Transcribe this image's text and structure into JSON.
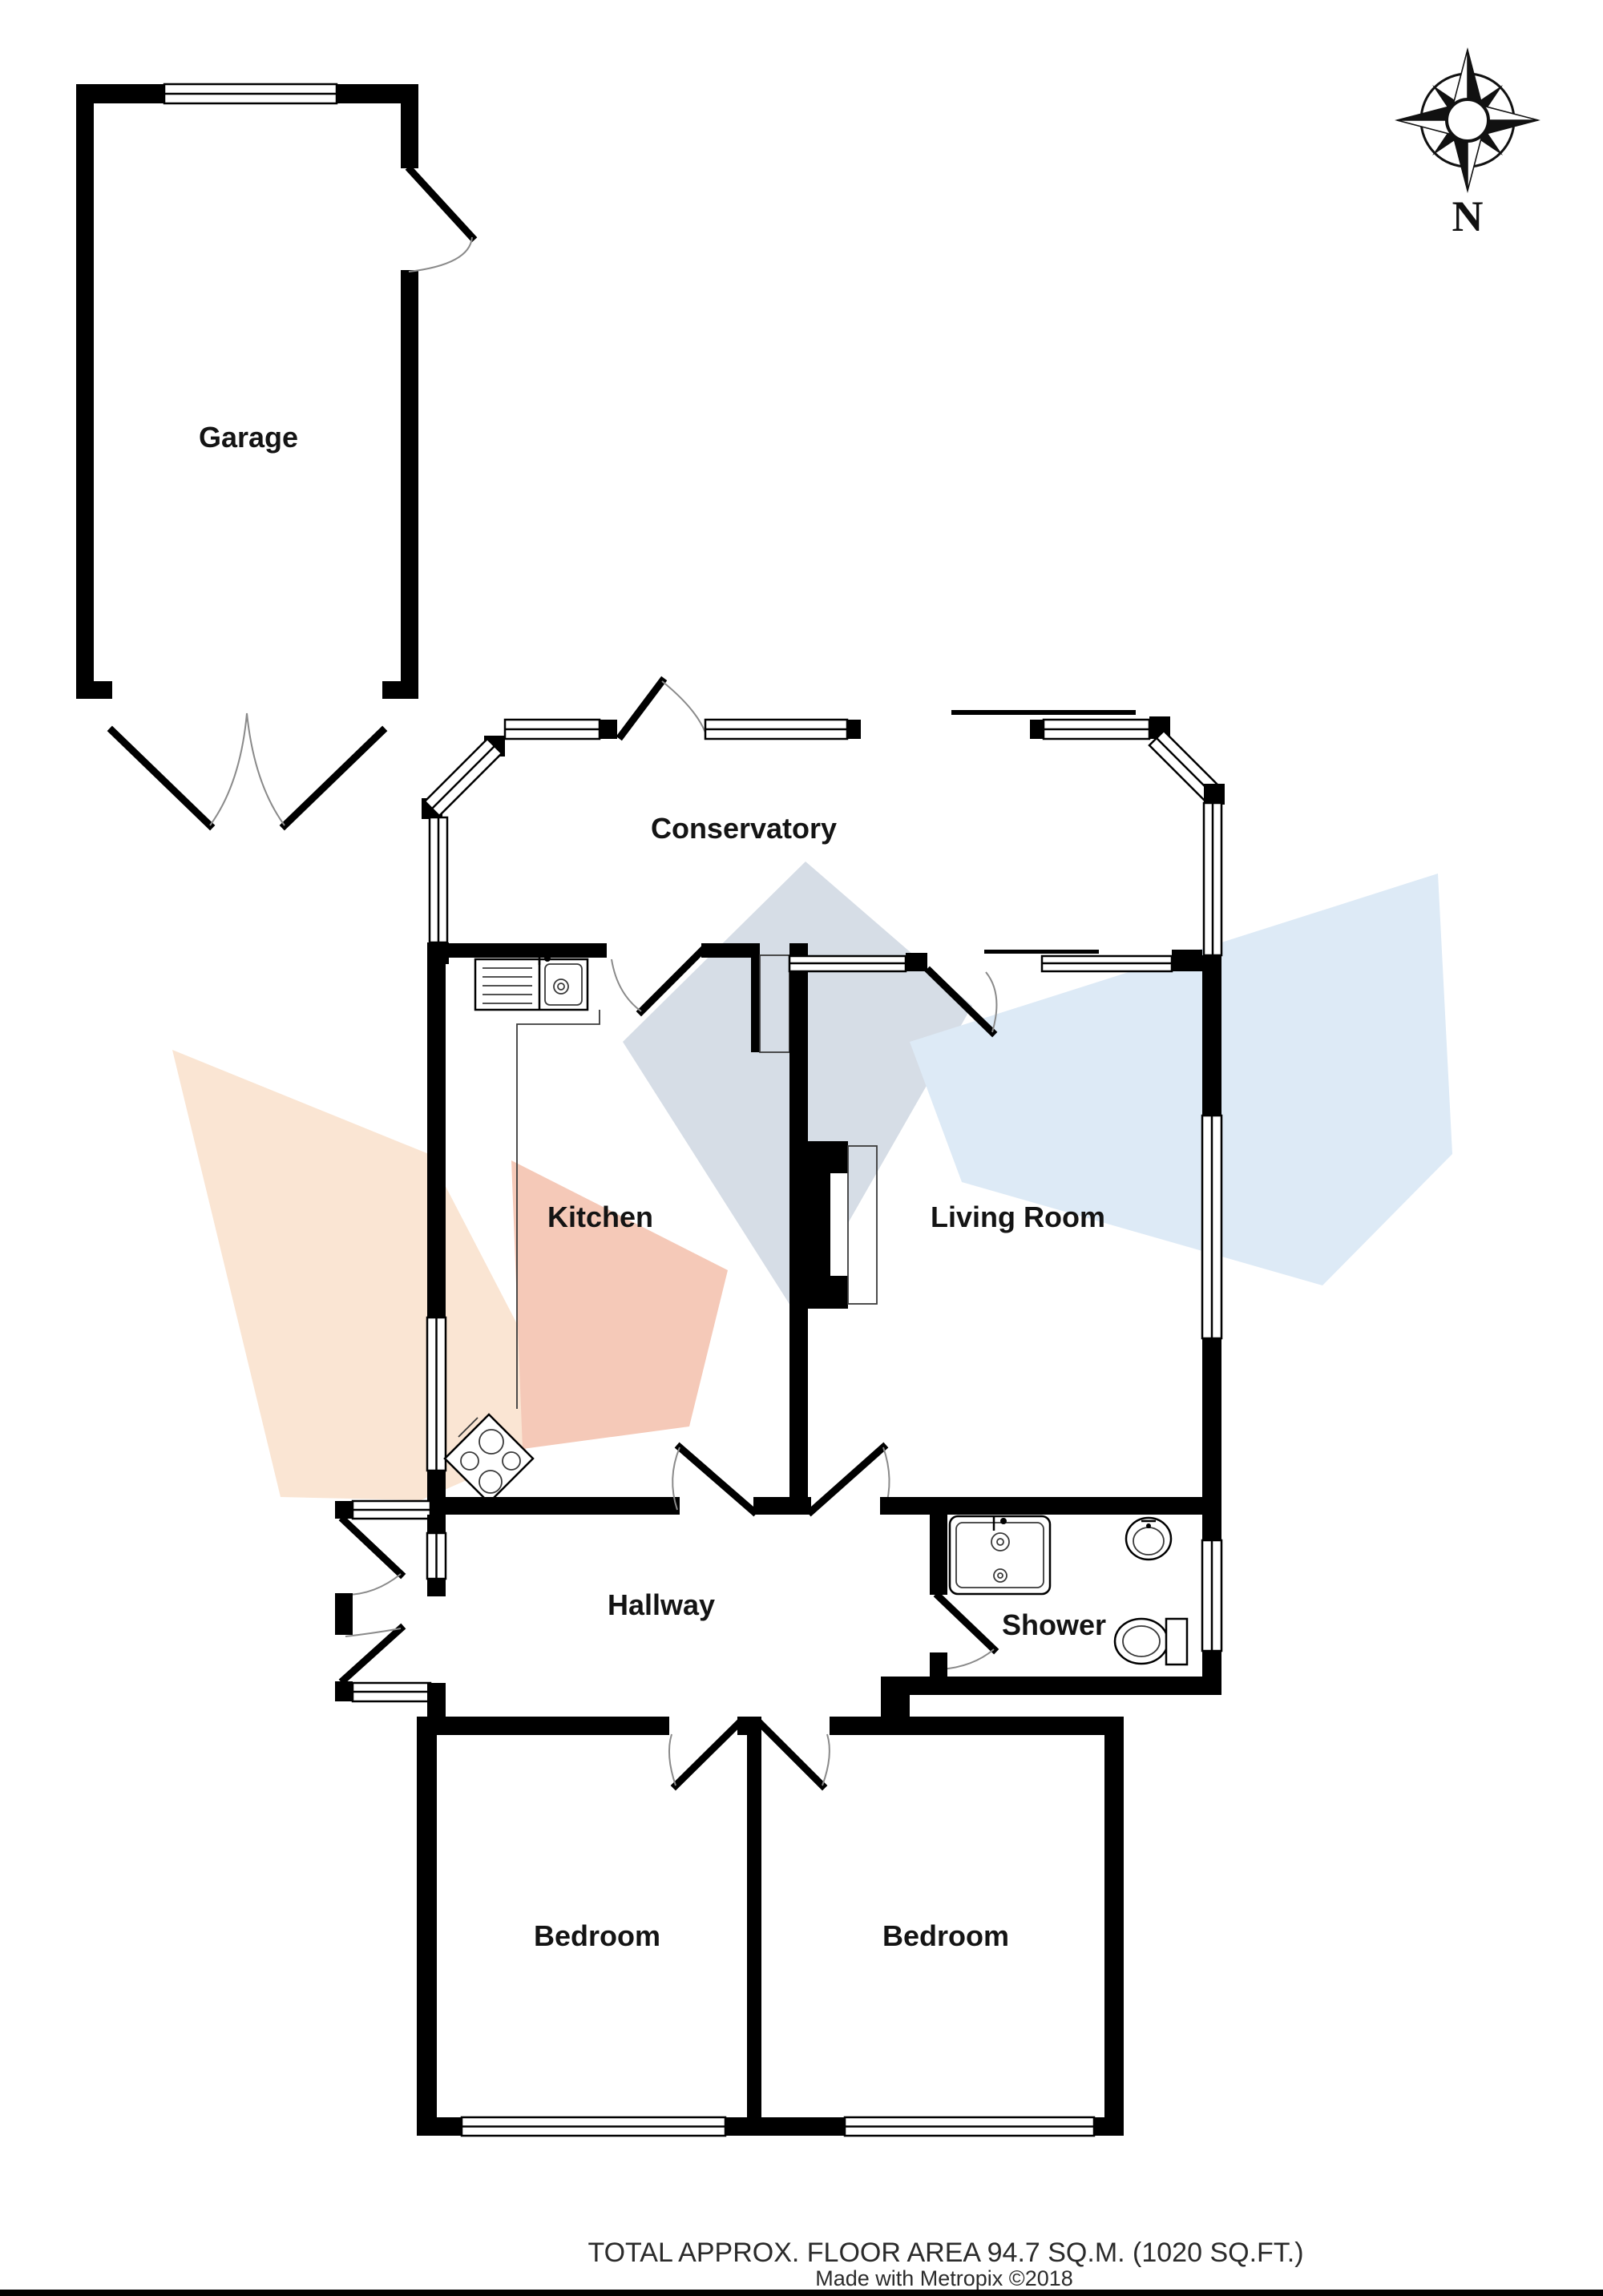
{
  "rooms": {
    "garage": "Garage",
    "conservatory": "Conservatory",
    "kitchen": "Kitchen",
    "living_room": "Living Room",
    "hallway": "Hallway",
    "shower": "Shower",
    "bedroom_left": "Bedroom",
    "bedroom_right": "Bedroom"
  },
  "compass": {
    "north_label": "N"
  },
  "footer": {
    "area_text": "TOTAL APPROX. FLOOR AREA 94.7 SQ.M. (1020 SQ.FT.)",
    "credit_text": "Made with Metropix ©2018"
  },
  "colors": {
    "wall": "#000000",
    "watermark_peach": "#fae5d3",
    "watermark_pink": "#f5c9b8",
    "watermark_gray_blue": "#d6dde6",
    "watermark_light_blue": "#ddeaf6"
  }
}
